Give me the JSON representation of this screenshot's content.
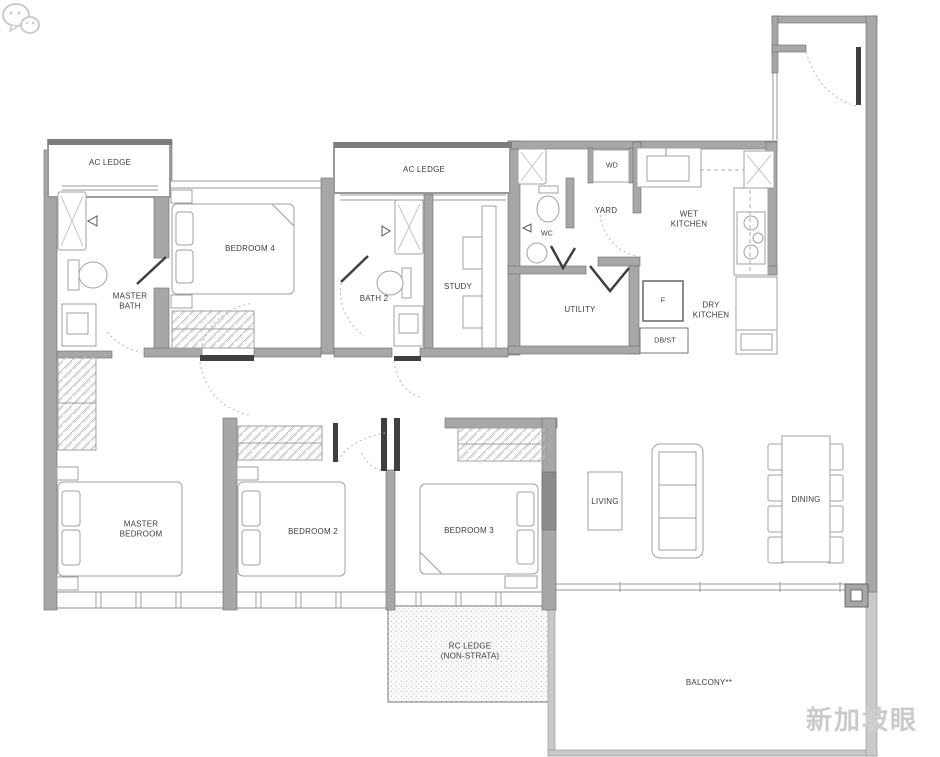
{
  "plan": {
    "title": "apartment-floor-plan",
    "labels": {
      "ac_ledge_1": "AC LEDGE",
      "ac_ledge_2": "AC LEDGE",
      "bedroom_4": "BEDROOM 4",
      "master_bath": "MASTER\nBATH",
      "bath_2": "BATH 2",
      "study": "STUDY",
      "wc": "WC",
      "yard": "YARD",
      "wd": "WD",
      "wet_kitchen": "WET\nKITCHEN",
      "utility": "UTILITY",
      "fridge": "F",
      "dry_kitchen": "DRY\nKITCHEN",
      "db_st": "DB/ST",
      "master_bedroom": "MASTER\nBEDROOM",
      "bedroom_2": "BEDROOM 2",
      "bedroom_3": "BEDROOM 3",
      "living": "LIVING",
      "dining": "DINING",
      "rc_ledge": "RC LEDGE\n(NON-STRATA)",
      "balcony": "BALCONY**"
    },
    "watermark": {
      "text": "新加坡眼",
      "icon": "chat-bubbles-logo",
      "color": "#cbcbcb"
    },
    "colors": {
      "wall": "#a7a7a7",
      "wall_dark": "#3f3f3f",
      "wall_light": "#c9c9c9",
      "thin_line": "#8f8f8f",
      "furniture_line": "#a0a0a0",
      "hatch_line": "#b5b5b5",
      "label_text": "#3d3d3d",
      "ledge_dots": "#bdbdbd",
      "door_arc": "#b8b8b8"
    },
    "fixture_icons": [
      "shower-icon",
      "toilet-icon",
      "vanity-sink-icon",
      "double-bed-icon",
      "wardrobe-icon",
      "study-desk-icon",
      "chair-icon",
      "kitchen-sink-icon",
      "cooker-hob-icon",
      "fridge-icon",
      "washer-dryer-icon",
      "sofa-icon",
      "tv-console-icon",
      "dining-table-icon",
      "dining-chair-icon",
      "door-swing-icon",
      "bifold-door-icon",
      "window-band-icon",
      "rc-ledge-dotted-area",
      "entry-door-icon"
    ]
  }
}
